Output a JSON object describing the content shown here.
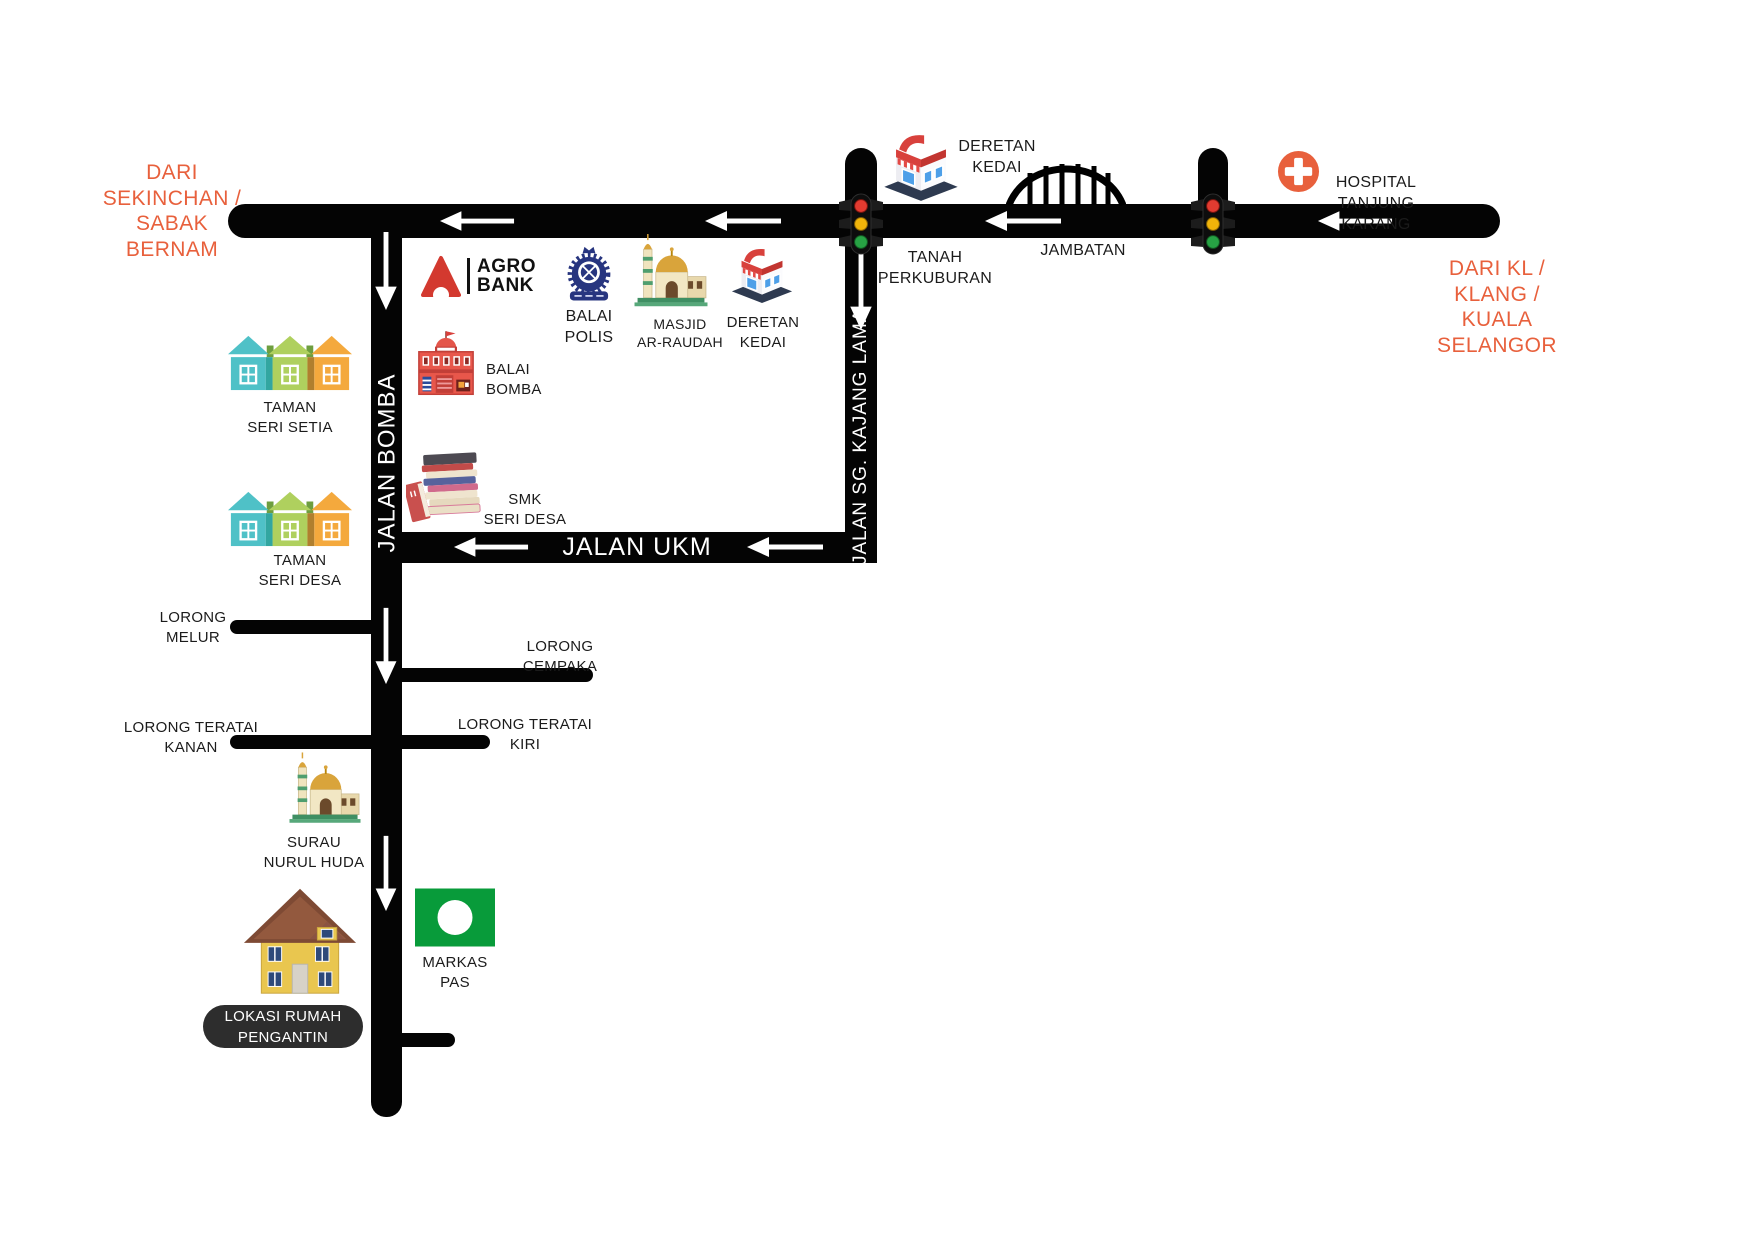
{
  "directions": {
    "from_sekinchan": "DARI\nSEKINCHAN /\nSABAK\nBERNAM",
    "from_kl": "DARI KL /\nKLANG /\nKUALA\nSELANGOR"
  },
  "roads": {
    "jalan_bomba": "JALAN BOMBA",
    "jalan_sg_kajang_lama": "JALAN SG. KAJANG LAMA",
    "jalan_ukm": "JALAN UKM",
    "lorong_melur": "LORONG\nMELUR",
    "lorong_cempaka": "LORONG\nCEMPAKA",
    "lorong_teratai_kanan": "LORONG TERATAI\nKANAN",
    "lorong_teratai_kiri": "LORONG TERATAI\nKIRI"
  },
  "landmarks": {
    "deretan_kedai_top": "DERETAN\nKEDAI",
    "jambatan": "JAMBATAN",
    "hospital": "HOSPITAL\nTANJUNG KARANG",
    "tanah_perkuburan": "TANAH\nPERKUBURAN",
    "agrobank": "AGRO\nBANK",
    "balai_polis": "BALAI\nPOLIS",
    "masjid": "MASJID\nAR-RAUDAH",
    "deretan_kedai_mid": "DERETAN\nKEDAI",
    "balai_bomba": "BALAI\nBOMBA",
    "taman_seri_setia": "TAMAN\nSERI SETIA",
    "taman_seri_desa": "TAMAN\nSERI DESA",
    "smk_seri_desa": "SMK\nSERI DESA",
    "surau": "SURAU\nNURUL HUDA",
    "markas_pas": "MARKAS\nPAS",
    "lokasi_rumah_pengantin": "LOKASI RUMAH\nPENGANTIN"
  },
  "colors": {
    "road": "#040404",
    "accent_orange": "#E8603C",
    "badge_bg": "#2D2D2D",
    "pas_green": "#089B3A",
    "house_teal": "#4FC1C7",
    "house_green": "#AFD05E",
    "house_orange": "#F4A93D"
  }
}
